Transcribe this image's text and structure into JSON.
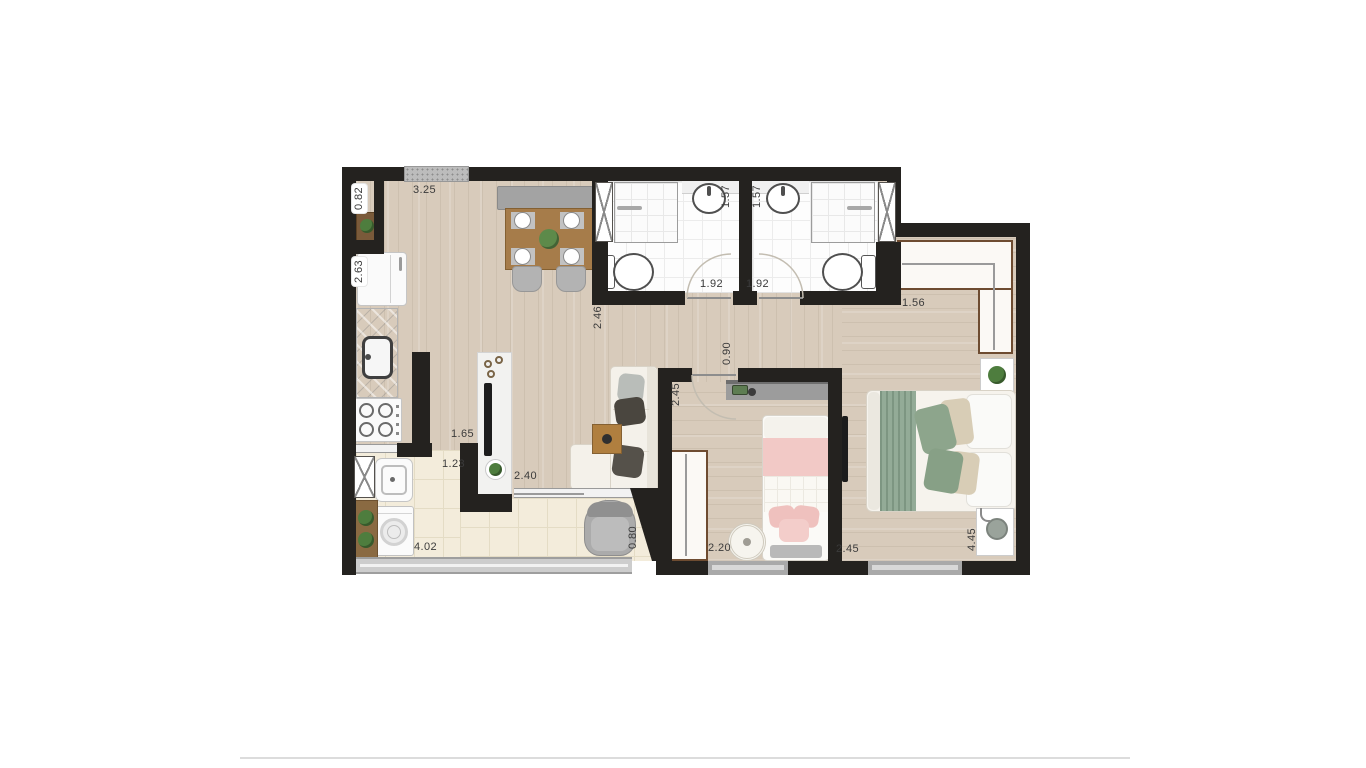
{
  "plan": {
    "type": "apartment-floor-plan-top-view",
    "labels": {
      "niche_width": "0.82",
      "living_width": "3.25",
      "bath1_depth": "1.57",
      "bath2_depth": "1.57",
      "kitchen_counter": "2.63",
      "living_depth": "2.46",
      "bath1_width": "1.92",
      "bath2_width": "1.92",
      "closet_width": "1.56",
      "hall_width": "0.90",
      "child_room_depth": "2.45",
      "kitchen_passage": "1.65",
      "service_passage": "1.23",
      "balcony_door_width": "2.40",
      "child_room_width": "2.20",
      "master_room_width": "2.45",
      "master_room_depth": "4.45",
      "balcony_width": "4.02",
      "balcony_depth": "0.80"
    },
    "colors": {
      "wall": "#24221f",
      "wood_floor": "#d8cbbb",
      "balcony_tile": "#f3ecdb",
      "bath_floor": "#fdfdfd",
      "furniture_wood": "#a67c4a",
      "closet_trim": "#6e4c31",
      "plant_green": "#4e7d3e",
      "sage_green": "#93ab97",
      "bed_pink": "#f2c9c6",
      "label_text": "#3b3b3b"
    }
  }
}
